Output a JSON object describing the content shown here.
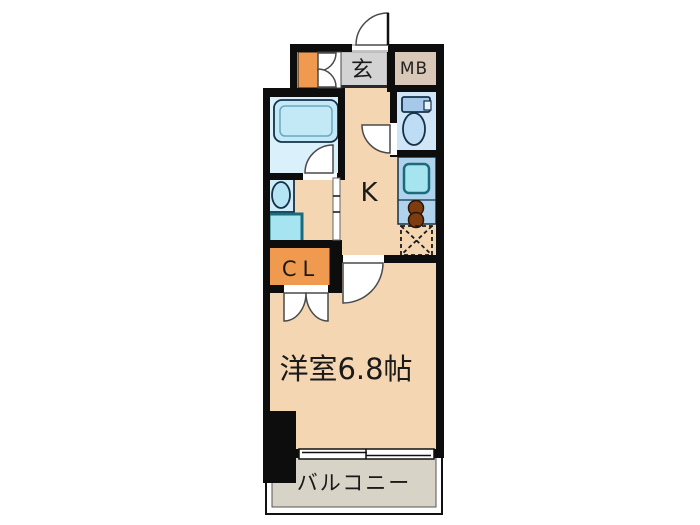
{
  "floorplan": {
    "title": "1K apartment floor plan",
    "labels": {
      "entrance": "玄",
      "meter_box": "MB",
      "kitchen": "K",
      "closet": "CL",
      "main_room": "洋室6.8帖",
      "balcony": "バルコニー"
    },
    "colors": {
      "wall": "#0d0d0d",
      "floor_wood": "#f4d6b2",
      "entrance_tile": "#d3d3d3",
      "meter_box": "#d9c8b7",
      "closet_orange": "#ef9a4f",
      "bathroom_bg": "#daf0fa",
      "bathtub": "#c3e9f7",
      "toilet_room_bg": "#d0e5f5",
      "toilet_tank": "#a6c9ea",
      "toilet_bowl": "#bedcf4",
      "kitchen_counter": "#afd3ed",
      "sink_cyan": "#a6e5f0",
      "sink_border_teal": "#1a6c7c",
      "burner_brown": "#7d3d10",
      "washbasin_pad": "#cfecf8",
      "balcony_floor": "#d8d3c7",
      "background": "#ffffff"
    }
  }
}
